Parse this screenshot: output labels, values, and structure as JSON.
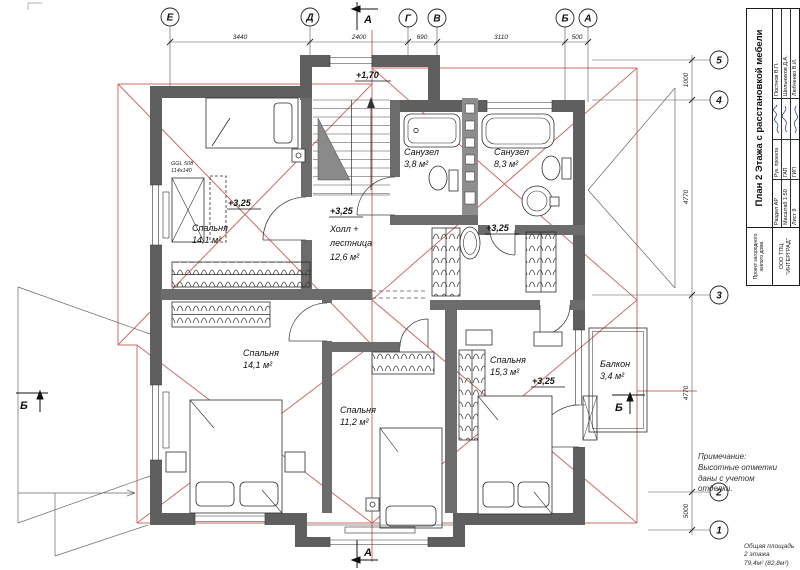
{
  "axes": {
    "top": [
      "Е",
      "Д",
      "Г",
      "В",
      "Б",
      "А"
    ],
    "right": [
      "5",
      "4",
      "3",
      "2",
      "1"
    ]
  },
  "dims": {
    "top": [
      "3440",
      "2400",
      "690",
      "3110",
      "500"
    ],
    "right": [
      "1000",
      "4770",
      "4770",
      "5000"
    ]
  },
  "sections": {
    "a": "А",
    "b": "Б"
  },
  "rooms": {
    "bedroom_tl": {
      "name": "Спальня",
      "area": "14,1 м²",
      "elevation": "+3,25"
    },
    "hall": {
      "elevation": "+3,25",
      "name_line1": "Холл +",
      "name_line2": "лестница",
      "area": "12,6 м²"
    },
    "stairs": {
      "elevation": "+1,70"
    },
    "bath_small": {
      "name": "Санузел",
      "area": "3,8 м²"
    },
    "bath_big": {
      "name": "Санузел",
      "area": "8,3 м²"
    },
    "corridor": {
      "elevation": "+3,25"
    },
    "bedroom_bl": {
      "name": "Спальня",
      "area": "14,1 м²"
    },
    "bedroom_bm": {
      "name": "Спальня",
      "area": "11,2 м²"
    },
    "bedroom_br": {
      "name": "Спальня",
      "area": "15,3 м²",
      "elevation": "+3,25"
    },
    "balcony": {
      "name": "Балкон",
      "area": "3,4 м²"
    }
  },
  "skylight": {
    "model": "GGL 508",
    "size": "114х140"
  },
  "title_block": {
    "title": "План 2 Этажа с расстановкой мебели",
    "project": "Проект загородного жилого дома",
    "company": "ООО ТПЦ \"ИНТЕРГРАД\"",
    "rows": [
      {
        "cell": "Раздел АР",
        "role": "Рук. проекта",
        "name": "Постнов В.П."
      },
      {
        "cell": "Масштаб 1:50",
        "role": "ГАП",
        "name": "Шильников Д.А."
      },
      {
        "cell": "Лист 9",
        "role": "ГИП",
        "name": "Любченко В.И."
      }
    ]
  },
  "note": {
    "line1": "Примечание:",
    "line2": "Высотные отметки",
    "line3": "даны с учетом",
    "line4": "отделки."
  },
  "total_area": {
    "line1": "Общая площадь",
    "line2": "2 этажа",
    "line3": "79,4м² (82,8м²)"
  }
}
